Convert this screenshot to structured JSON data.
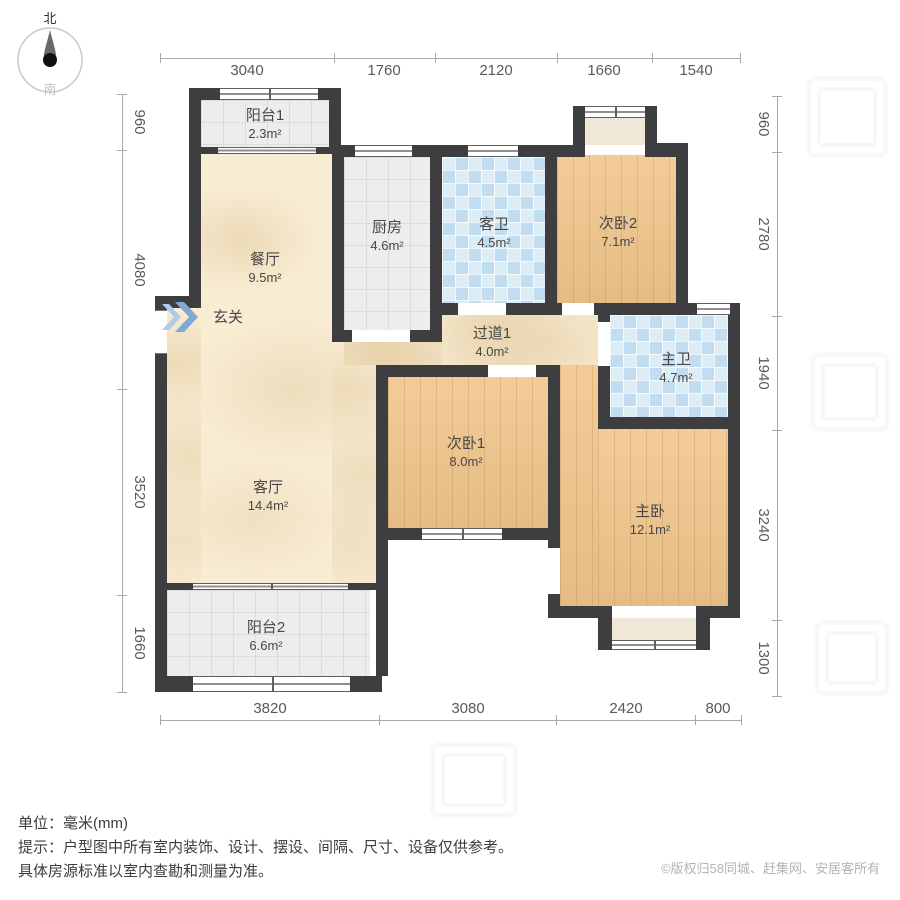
{
  "compass": {
    "north": "北",
    "south": "南"
  },
  "rooms": {
    "balcony1": {
      "name": "阳台1",
      "area": "2.3m²"
    },
    "dining": {
      "name": "餐厅",
      "area": "9.5m²"
    },
    "kitchen": {
      "name": "厨房",
      "area": "4.6m²"
    },
    "guest_bath": {
      "name": "客卫",
      "area": "4.5m²"
    },
    "bedroom2": {
      "name": "次卧2",
      "area": "7.1m²"
    },
    "entry": {
      "name": "玄关"
    },
    "hallway": {
      "name": "过道1",
      "area": "4.0m²"
    },
    "master_bath": {
      "name": "主卫",
      "area": "4.7m²"
    },
    "bedroom1": {
      "name": "次卧1",
      "area": "8.0m²"
    },
    "living": {
      "name": "客厅",
      "area": "14.4m²"
    },
    "master_bedroom": {
      "name": "主卧",
      "area": "12.1m²"
    },
    "balcony2": {
      "name": "阳台2",
      "area": "6.6m²"
    }
  },
  "dims": {
    "top": [
      "3040",
      "1760",
      "2120",
      "1660",
      "1540"
    ],
    "left": [
      "960",
      "4080",
      "3520",
      "1660"
    ],
    "right": [
      "960",
      "2780",
      "1940",
      "3240",
      "1300"
    ],
    "bottom": [
      "3820",
      "3080",
      "2420",
      "800"
    ]
  },
  "notes": {
    "unit": "单位：毫米(mm)",
    "tip1": "提示：户型图中所有室内装饰、设计、摆设、间隔、尺寸、设备仅供参考。",
    "tip2": "具体房源标准以室内查勘和测量为准。",
    "copyright": "©版权归58同城、赶集网、安居客所有"
  }
}
